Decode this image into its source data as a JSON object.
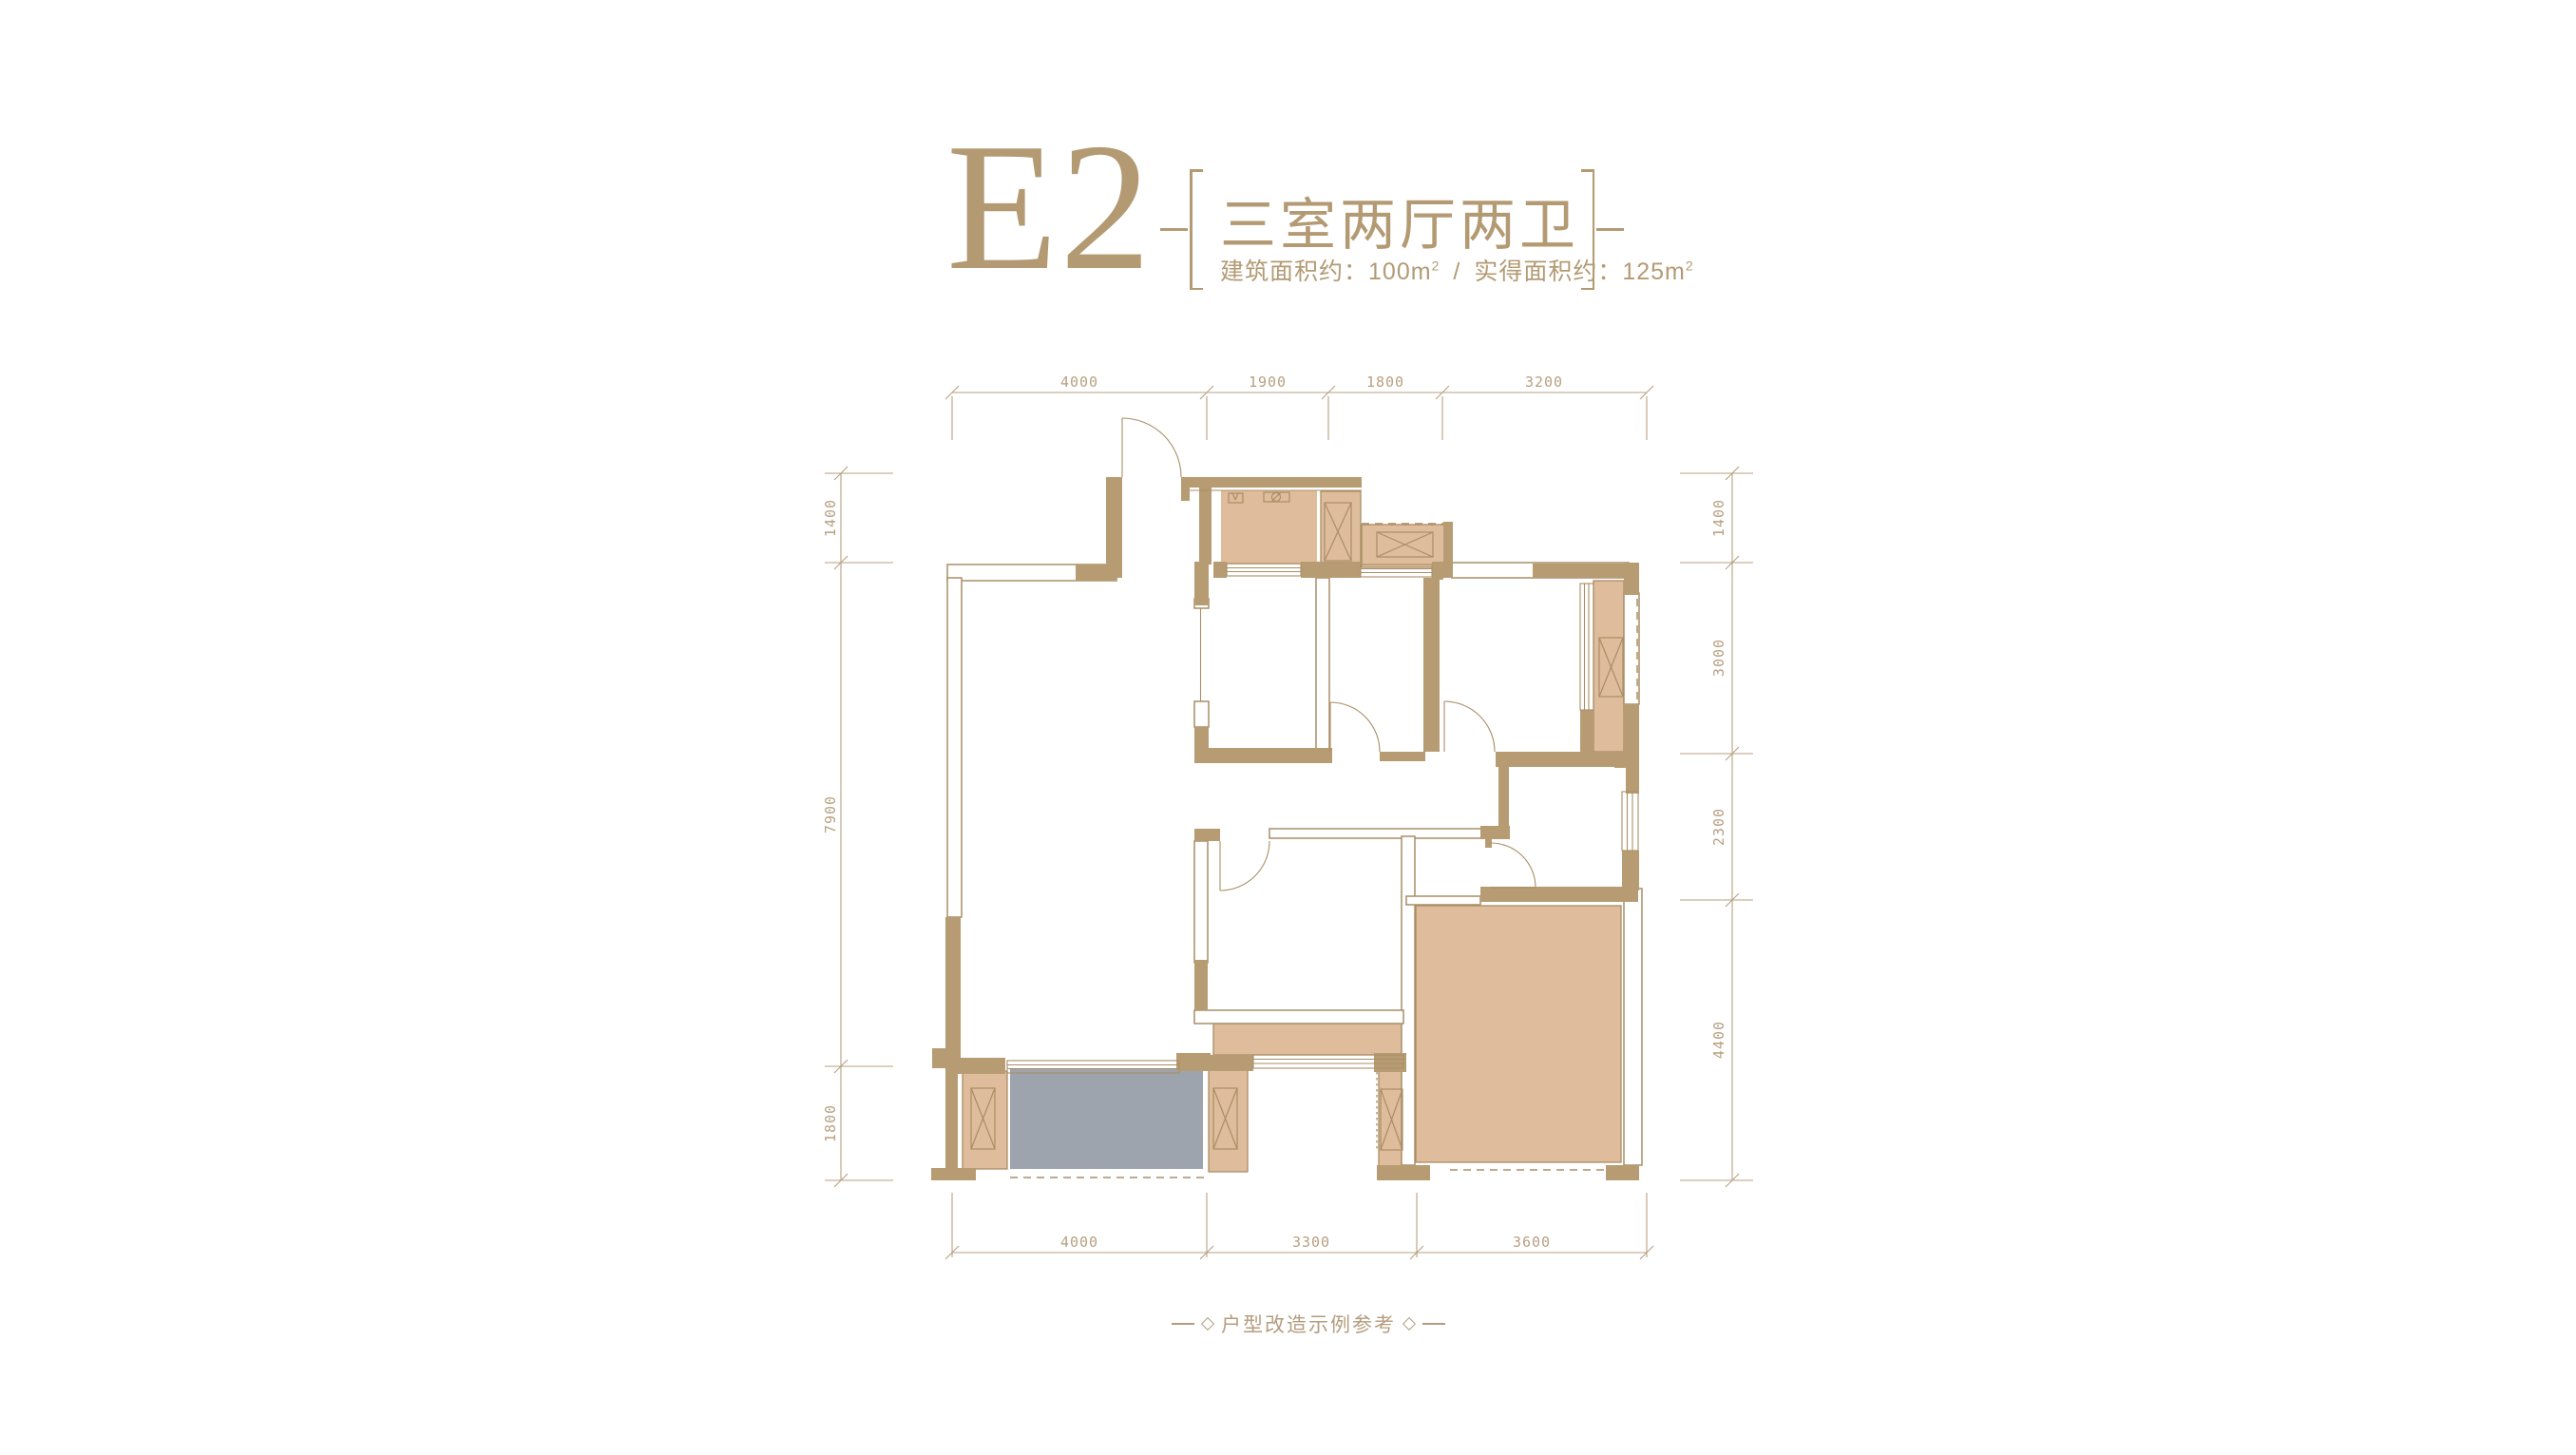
{
  "title": {
    "unit": "E2",
    "layout_name": "三室两厅两卫",
    "area": {
      "built_label": "建筑面积约：",
      "built_value": "100m",
      "built_sup": "2",
      "separator": "/",
      "usable_label": "实得面积约：",
      "usable_value": "125m",
      "usable_sup": "2"
    }
  },
  "dims": {
    "top": [
      "4000",
      "1900",
      "1800",
      "3200"
    ],
    "bottom": [
      "4000",
      "3300",
      "3600"
    ],
    "left": [
      "1400",
      "7900",
      "1800"
    ],
    "right": [
      "1400",
      "3000",
      "2300",
      "4400"
    ]
  },
  "caption": {
    "text": "户型改造示例参考"
  },
  "colors": {
    "accent": "#b39a73",
    "wall": "#b79c73",
    "line": "#a98e66",
    "room_fill": "#dfbc9b",
    "highlight_fill": "#9da4ae",
    "dim_text": "#b7a081"
  }
}
